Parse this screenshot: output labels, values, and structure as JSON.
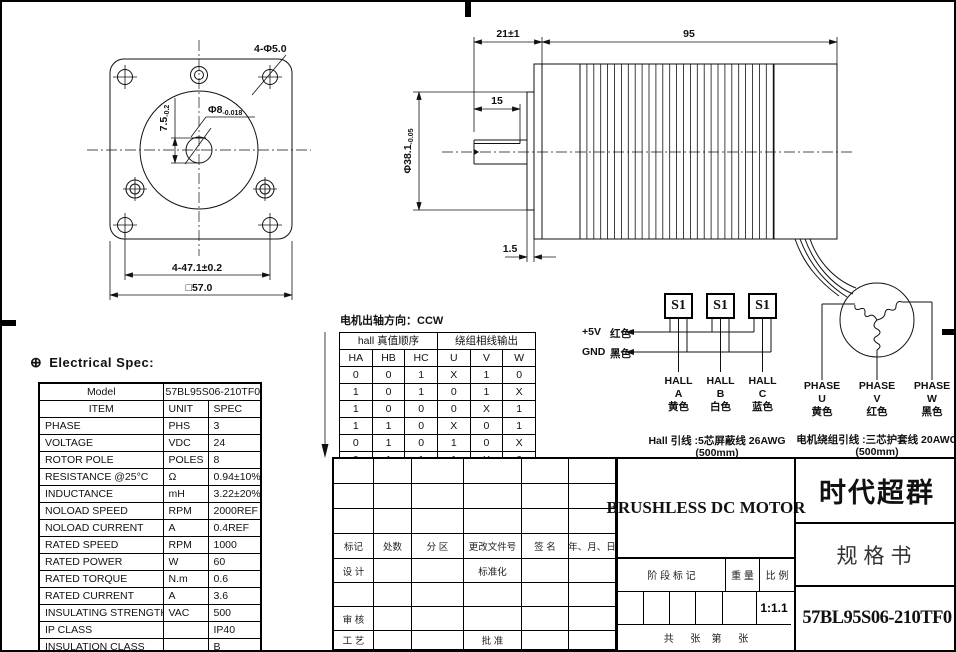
{
  "drawing": {
    "front_view": {
      "dim_holes": "4-Φ5.0",
      "shaft_dia": {
        "main": "Φ8",
        "tol": "-0.018"
      },
      "flat_depth": {
        "main": "7.5",
        "tol": "-0.2"
      },
      "dim_bolt_spacing": "4-47.1±0.2",
      "dim_square": "□57.0"
    },
    "side_view": {
      "dim_shaft_len": "21±1",
      "dim_body_len": "95",
      "dim_flat_len": "15",
      "pilot_dia": {
        "main": "Φ38.1",
        "tol": "-0.05"
      },
      "dim_boss": "1.5"
    }
  },
  "electrical_spec": {
    "section_title": "Electrical Spec:",
    "globe_icon": "⊕",
    "model_label": "Model",
    "model_value": "57BL95S06-210TF0",
    "headers": [
      "ITEM",
      "UNIT",
      "SPEC"
    ],
    "rows": [
      [
        "PHASE",
        "PHS",
        "3"
      ],
      [
        "VOLTAGE",
        "VDC",
        "24"
      ],
      [
        "ROTOR POLE",
        "POLES",
        "8"
      ],
      [
        "RESISTANCE @25°C",
        "Ω",
        "0.94±10%"
      ],
      [
        "INDUCTANCE",
        "mH",
        "3.22±20%"
      ],
      [
        "NOLOAD SPEED",
        "RPM",
        "2000REF"
      ],
      [
        "NOLOAD CURRENT",
        "A",
        "0.4REF"
      ],
      [
        "RATED SPEED",
        "RPM",
        "1000"
      ],
      [
        "RATED POWER",
        "W",
        "60"
      ],
      [
        "RATED TORQUE",
        "N.m",
        "0.6"
      ],
      [
        "RATED CURRENT",
        "A",
        "3.6"
      ],
      [
        "INSULATING STRENGTH",
        "VAC",
        "500"
      ],
      [
        "IP CLASS",
        "",
        "IP40"
      ],
      [
        "INSULATION CLASS",
        "",
        "B"
      ]
    ]
  },
  "hall_section": {
    "direction_note": "电机出轴方向：CCW",
    "header_left": "hall 真值顺序",
    "header_right": "绕组相线输出",
    "columns": [
      "HA",
      "HB",
      "HC",
      "U",
      "V",
      "W"
    ],
    "rows": [
      [
        "0",
        "0",
        "1",
        "X",
        "1",
        "0"
      ],
      [
        "1",
        "0",
        "1",
        "0",
        "1",
        "X"
      ],
      [
        "1",
        "0",
        "0",
        "0",
        "X",
        "1"
      ],
      [
        "1",
        "1",
        "0",
        "X",
        "0",
        "1"
      ],
      [
        "0",
        "1",
        "0",
        "1",
        "0",
        "X"
      ],
      [
        "0",
        "1",
        "1",
        "1",
        "X",
        "0"
      ]
    ]
  },
  "hall_wiring": {
    "sensor_label": "S1",
    "vcc_label": "+5V",
    "vcc_color": "红色",
    "gnd_label": "GND",
    "gnd_color": "黑色",
    "halls": [
      {
        "name": "HALL",
        "id": "A",
        "color": "黄色"
      },
      {
        "name": "HALL",
        "id": "B",
        "color": "白色"
      },
      {
        "name": "HALL",
        "id": "C",
        "color": "蓝色"
      }
    ],
    "lead_note_1": "Hall 引线 :5芯屏蔽线 26AWG",
    "lead_note_2": "(500mm)"
  },
  "winding": {
    "phases": [
      {
        "name": "PHASE",
        "id": "U",
        "color": "黄色"
      },
      {
        "name": "PHASE",
        "id": "V",
        "color": "红色"
      },
      {
        "name": "PHASE",
        "id": "W",
        "color": "黑色"
      }
    ],
    "lead_note_1": "电机绕组引线 :三芯护套线 20AWG",
    "lead_note_2": "(500mm)"
  },
  "title_block": {
    "product": "BRUSHLESS DC MOTOR",
    "company": "时代超群",
    "doc_type": "规格书",
    "part_number": "57BL95S06-210TF0",
    "rev_headers": [
      "标记",
      "处数",
      "分 区",
      "更改文件号",
      "签 名",
      "年、月、日"
    ],
    "design_label": "设 计",
    "standard_label": "标准化",
    "audit_label": "审 核",
    "process_label": "工 艺",
    "approve_label": "批 准",
    "stage_label": "阶 段 标 记",
    "weight_label": "重 量",
    "scale_label": "比 例",
    "scale_value": "1:1.1",
    "sheet_label": "共      张    第      张"
  }
}
